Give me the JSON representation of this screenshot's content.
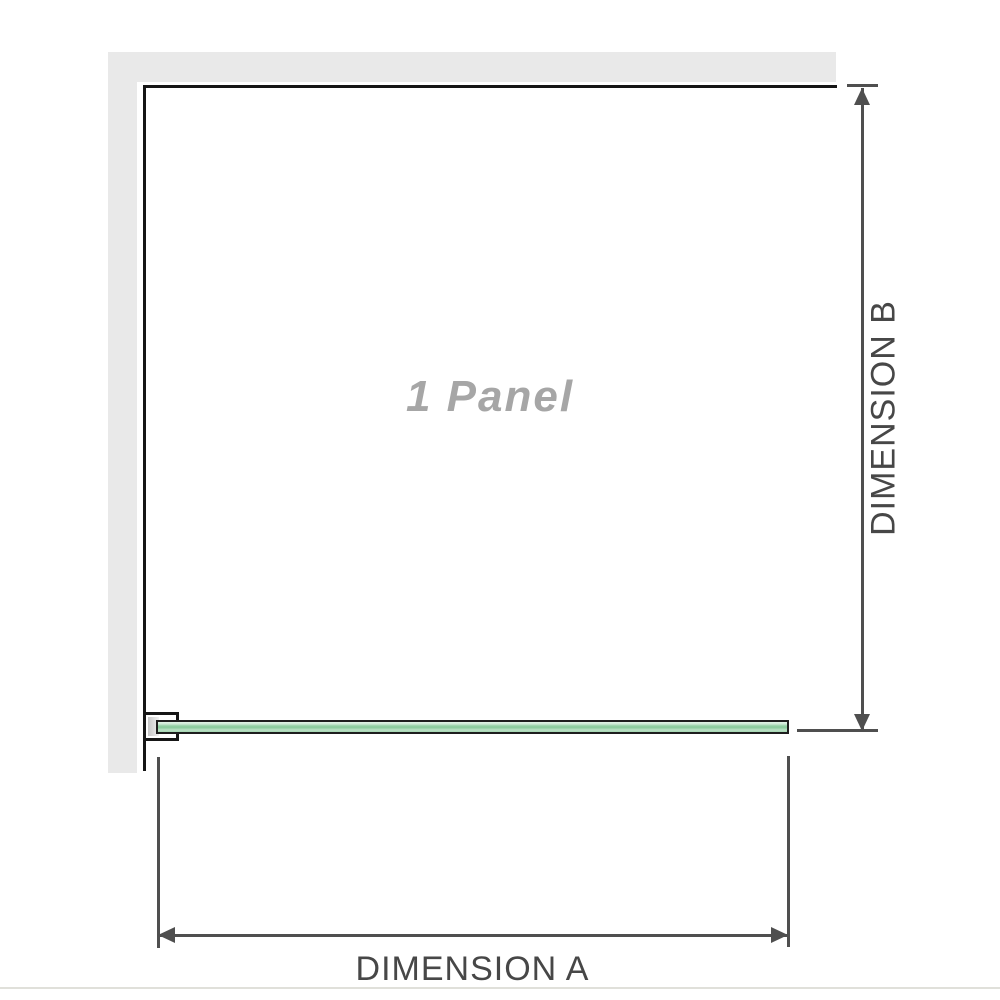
{
  "scene": {
    "panel_label": "1 Panel",
    "dimension_a_label": "DIMENSION A",
    "dimension_b_label": "DIMENSION B"
  },
  "icons": {
    "dimension_a_arrows": "left-right-arrowhead-pair",
    "dimension_b_arrows": "up-down-arrowhead-pair"
  },
  "colors": {
    "wall": "#e9e9e9",
    "panel_outline": "#161616",
    "glass_green_dark": "#8acb9c",
    "glass_green_light": "#cdead5",
    "dimension_line": "#4f4f4f",
    "dimension_text": "#474747",
    "watermark_text": "#a6a6a6",
    "divider": "#e0e0da"
  }
}
